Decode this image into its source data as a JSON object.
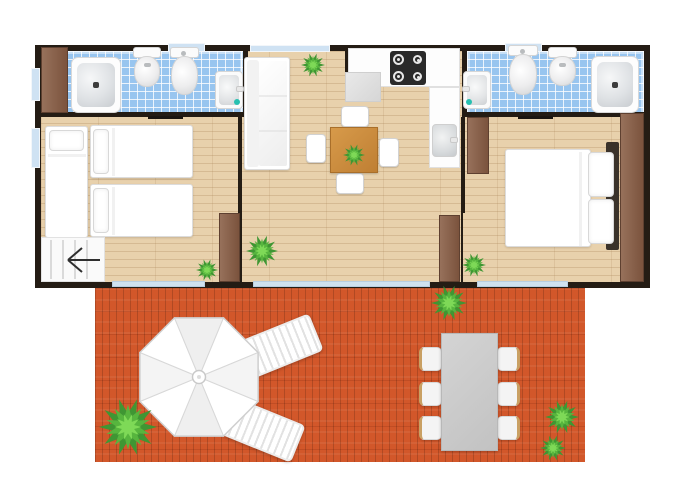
{
  "scene": {
    "type": "mobile-home floor plan, top view, with terrace",
    "areas": [
      "bathroom-left",
      "twin-bedroom",
      "living-dining-kitchen",
      "bathroom-right",
      "double-bedroom",
      "terrace-deck"
    ]
  },
  "inventory": {
    "bathroom_left": [
      "shower",
      "bidet",
      "toilet",
      "washbasin",
      "wardrobe"
    ],
    "twin_bedroom": [
      "single-bed-vertical",
      "single-bed",
      "single-bed",
      "wardrobe-with-arrow"
    ],
    "living_area": [
      "corner-sofa",
      "dining-table",
      "chairs-x4",
      "plant"
    ],
    "kitchen": [
      "hob-4-burners",
      "counter",
      "kitchen-sink",
      "appliance"
    ],
    "bathroom_right": [
      "washbasin",
      "toilet",
      "bidet",
      "shower"
    ],
    "double_bedroom": [
      "double-bed",
      "pillows-x2",
      "headboard",
      "wardrobe-x2",
      "plant"
    ],
    "terrace": [
      "parasol",
      "sun-lounger-x2",
      "garden-table",
      "garden-chairs-x6",
      "plants-x4"
    ]
  },
  "counts": {
    "plants_total": 9,
    "glass_doors": 3,
    "windows": 5,
    "interior_doors": 2
  },
  "palette": {
    "wall": "#241c14",
    "tile_blue": "#98c5ef",
    "interior_wood": "#e8d1ac",
    "deck_wood": "#d2572a",
    "furniture_white": "#ffffff",
    "wardrobe_brown": "#8a6148",
    "table_brown": "#c78a3c",
    "plant_green": "#57b53e",
    "drain_teal": "#27c0b0",
    "glass_blue": "#cfe2f0"
  }
}
